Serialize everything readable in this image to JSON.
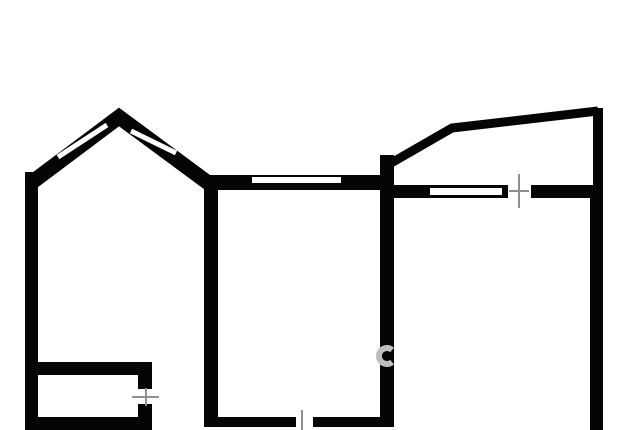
{
  "canvas": {
    "width": 640,
    "height": 430,
    "background": "#ffffff"
  },
  "colors": {
    "wall": "#050505",
    "window": "#ffffff",
    "tick": "#8f8f8f",
    "watermark": "#bfbfbf"
  },
  "floorplan": {
    "viewbox": "0 0 640 430",
    "elements": [
      {
        "name": "left-outer-wall",
        "kind": "wall",
        "shape": "rect",
        "x": 25,
        "y": 172,
        "w": 13,
        "h": 258
      },
      {
        "name": "bay-peak-walls",
        "kind": "wall",
        "shape": "polyline",
        "points": "31,183 119,117 211,185",
        "width": 15
      },
      {
        "name": "bay-left-window-slot",
        "kind": "window",
        "shape": "line",
        "x1": 58,
        "y1": 157,
        "x2": 107,
        "y2": 125,
        "width": 5
      },
      {
        "name": "bay-right-window-slot",
        "kind": "window",
        "shape": "line",
        "x1": 131,
        "y1": 131,
        "x2": 176,
        "y2": 153,
        "width": 5
      },
      {
        "name": "central-room-left-wall",
        "kind": "wall",
        "shape": "rect",
        "x": 204,
        "y": 176,
        "w": 14,
        "h": 251
      },
      {
        "name": "central-room-top-wall",
        "kind": "wall",
        "shape": "rect",
        "x": 204,
        "y": 175,
        "w": 190,
        "h": 15
      },
      {
        "name": "central-top-window-slot",
        "kind": "window",
        "shape": "rect",
        "x": 252,
        "y": 177,
        "w": 89,
        "h": 6
      },
      {
        "name": "central-right-wall",
        "kind": "wall",
        "shape": "rect",
        "x": 380,
        "y": 155,
        "w": 14,
        "h": 272
      },
      {
        "name": "balcony-angled-wall",
        "kind": "wall",
        "shape": "polyline",
        "points": "386,166 452,128 598,111",
        "width": 9
      },
      {
        "name": "balcony-right-wall",
        "kind": "wall",
        "shape": "rect",
        "x": 593,
        "y": 108,
        "w": 10,
        "h": 80
      },
      {
        "name": "right-room-top-wall-left",
        "kind": "wall",
        "shape": "rect",
        "x": 394,
        "y": 185,
        "w": 114,
        "h": 13
      },
      {
        "name": "right-room-top-window-slot",
        "kind": "window",
        "shape": "rect",
        "x": 430,
        "y": 188,
        "w": 72,
        "h": 7
      },
      {
        "name": "right-room-top-wall-right",
        "kind": "wall",
        "shape": "rect",
        "x": 531,
        "y": 185,
        "w": 72,
        "h": 13
      },
      {
        "name": "right-outer-wall",
        "kind": "wall",
        "shape": "rect",
        "x": 590,
        "y": 185,
        "w": 13,
        "h": 245
      },
      {
        "name": "storage-top-wall",
        "kind": "wall",
        "shape": "rect",
        "x": 38,
        "y": 362,
        "w": 114,
        "h": 13
      },
      {
        "name": "storage-door-stub-upper",
        "kind": "wall",
        "shape": "rect",
        "x": 138,
        "y": 375,
        "w": 14,
        "h": 14
      },
      {
        "name": "storage-door-stub-lower",
        "kind": "wall",
        "shape": "rect",
        "x": 138,
        "y": 404,
        "w": 14,
        "h": 14
      },
      {
        "name": "storage-bottom-wall",
        "kind": "wall",
        "shape": "rect",
        "x": 25,
        "y": 417,
        "w": 127,
        "h": 13
      },
      {
        "name": "central-bottom-wall-left",
        "kind": "wall",
        "shape": "rect",
        "x": 204,
        "y": 417,
        "w": 92,
        "h": 10
      },
      {
        "name": "central-bottom-wall-right",
        "kind": "wall",
        "shape": "rect",
        "x": 313,
        "y": 417,
        "w": 81,
        "h": 10
      },
      {
        "name": "right-door-tick-vertical",
        "kind": "tick",
        "shape": "line",
        "x1": 519,
        "y1": 174,
        "x2": 519,
        "y2": 208,
        "width": 2
      },
      {
        "name": "right-door-tick-horizontal",
        "kind": "tick",
        "shape": "line",
        "x1": 509,
        "y1": 191,
        "x2": 529,
        "y2": 191,
        "width": 2
      },
      {
        "name": "storage-door-tick-horizontal",
        "kind": "tick",
        "shape": "line",
        "x1": 132,
        "y1": 397,
        "x2": 159,
        "y2": 397,
        "width": 2
      },
      {
        "name": "storage-door-tick-vertical",
        "kind": "tick",
        "shape": "line",
        "x1": 146,
        "y1": 388,
        "x2": 146,
        "y2": 406,
        "width": 2
      },
      {
        "name": "central-bottom-door-tick",
        "kind": "tick",
        "shape": "line",
        "x1": 302,
        "y1": 410,
        "x2": 302,
        "y2": 430,
        "width": 2
      },
      {
        "name": "watermark-letter-c",
        "kind": "watermark",
        "shape": "path",
        "d": "M 392.1 349.9 A 8 8 0 1 0 392.1 362.1",
        "width": 6
      }
    ]
  }
}
